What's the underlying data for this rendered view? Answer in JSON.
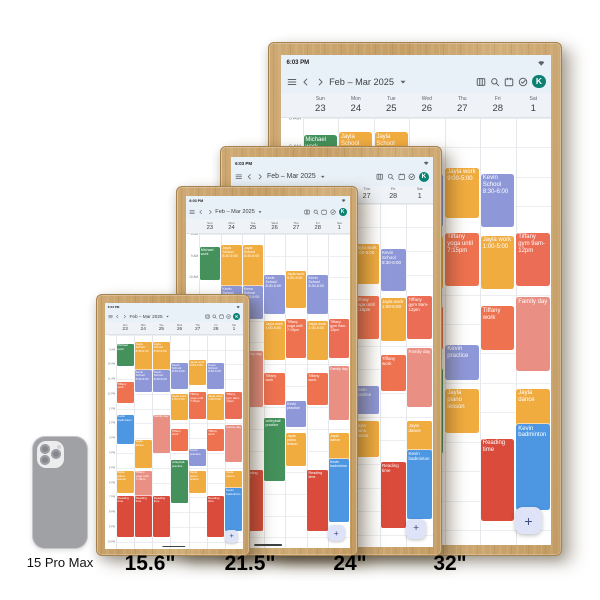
{
  "phone": {
    "label": "15 Pro Max"
  },
  "displays": [
    {
      "label": "15.6\""
    },
    {
      "label": "21.5\""
    },
    {
      "label": "24\""
    },
    {
      "label": "32\""
    }
  ],
  "calendar": {
    "status": {
      "time": "6:03 PM",
      "right_icon": "wifi-icon"
    },
    "title": "Feb – Mar 2025",
    "toolbar_icons": [
      "menu",
      "chevron-left",
      "chevron-right",
      "caret-down",
      "week-view",
      "search",
      "date",
      "tasks"
    ],
    "avatar": "K",
    "avatar_color": "#0b8073",
    "fab": "+",
    "days": [
      {
        "name": "Sun",
        "num": "23"
      },
      {
        "name": "Mon",
        "num": "24"
      },
      {
        "name": "Tue",
        "num": "25"
      },
      {
        "name": "Wed",
        "num": "26"
      },
      {
        "name": "Thu",
        "num": "27"
      },
      {
        "name": "Fri",
        "num": "28"
      },
      {
        "name": "Sat",
        "num": "1"
      }
    ],
    "time_labels": [
      "8 AM",
      "9 AM",
      "10 AM",
      "11 AM",
      "12 PM",
      "1 PM",
      "2 PM",
      "3 PM",
      "4 PM",
      "5 PM",
      "6 PM",
      "7 PM",
      "8 PM",
      "9 PM",
      "10 PM"
    ],
    "colors": {
      "yellow": "#F1AC40",
      "purple": "#8E98D8",
      "orange": "#EE7150",
      "salmon": "#E98F83",
      "gymred": "#EB6D56",
      "red": "#DA4B3B",
      "green": "#44915C",
      "blue": "#4D97E2"
    },
    "events": [
      {
        "day": 0,
        "label": "Michael work",
        "color": "green",
        "start": 8.6,
        "end": 10.1
      },
      {
        "day": 0,
        "label": "Tiffany work",
        "color": "orange",
        "start": 11.2,
        "end": 12.6
      },
      {
        "day": 0,
        "label": "Kevin badminton",
        "color": "blue",
        "start": 13.4,
        "end": 15.4
      },
      {
        "day": 0,
        "label": "Jayla piano lesson",
        "color": "yellow",
        "start": 17.2,
        "end": 18.7
      },
      {
        "day": 0,
        "label": "Reading time",
        "color": "red",
        "start": 18.9,
        "end": 21.7
      },
      {
        "day": 1,
        "label": "Jayla School 8:30-6:00",
        "color": "yellow",
        "start": 8.5,
        "end": 10.4
      },
      {
        "day": 1,
        "label": "Kevin School 8:30-6:00",
        "color": "purple",
        "start": 10.4,
        "end": 11.9
      },
      {
        "day": 1,
        "label": "Jayla dance",
        "color": "yellow",
        "start": 15.1,
        "end": 17.0
      },
      {
        "day": 1,
        "label": "Tiffany yoga until 7:15pm",
        "color": "salmon",
        "start": 17.2,
        "end": 18.9
      },
      {
        "day": 1,
        "label": "Reading time",
        "color": "red",
        "start": 18.9,
        "end": 21.7
      },
      {
        "day": 2,
        "label": "Jayla School 8:30-6:00",
        "color": "yellow",
        "start": 8.5,
        "end": 10.4
      },
      {
        "day": 2,
        "label": "Kevin School 8:30-6:00",
        "color": "purple",
        "start": 10.4,
        "end": 11.9
      },
      {
        "day": 2,
        "label": "Family day",
        "color": "salmon",
        "start": 13.4,
        "end": 16.0
      },
      {
        "day": 2,
        "label": "Reading time",
        "color": "red",
        "start": 18.9,
        "end": 21.7
      },
      {
        "day": 3,
        "label": "Kevin School 8:30-6:00",
        "color": "purple",
        "start": 9.9,
        "end": 11.7
      },
      {
        "day": 3,
        "label": "Jayla work 1:00-5:00",
        "color": "yellow",
        "start": 12.0,
        "end": 13.8
      },
      {
        "day": 3,
        "label": "Tiffany work",
        "color": "orange",
        "start": 14.4,
        "end": 15.9
      },
      {
        "day": 3,
        "label": "volleyball practice",
        "color": "green",
        "start": 16.5,
        "end": 19.4
      },
      {
        "day": 4,
        "label": "Jayla work 9:00-5:00",
        "color": "yellow",
        "start": 9.7,
        "end": 11.4
      },
      {
        "day": 4,
        "label": "Tiffany yoga until 7:15pm",
        "color": "orange",
        "start": 11.9,
        "end": 13.7
      },
      {
        "day": 4,
        "label": "Kevin practice",
        "color": "purple",
        "start": 15.7,
        "end": 16.9
      },
      {
        "day": 4,
        "label": "Jayla piano lesson",
        "color": "yellow",
        "start": 17.2,
        "end": 18.7
      },
      {
        "day": 5,
        "label": "Kevin School 8:30-6:00",
        "color": "purple",
        "start": 9.9,
        "end": 11.7
      },
      {
        "day": 5,
        "label": "Jayla work 1:00-5:00",
        "color": "yellow",
        "start": 12.0,
        "end": 13.8
      },
      {
        "day": 5,
        "label": "Tiffany work",
        "color": "orange",
        "start": 14.4,
        "end": 15.9
      },
      {
        "day": 5,
        "label": "Reading time",
        "color": "red",
        "start": 18.9,
        "end": 21.7
      },
      {
        "day": 6,
        "label": "Tiffany gym 9am-12pm",
        "color": "gymred",
        "start": 11.9,
        "end": 13.7
      },
      {
        "day": 6,
        "label": "Family day",
        "color": "salmon",
        "start": 14.1,
        "end": 16.6
      },
      {
        "day": 6,
        "label": "Jayla dance",
        "color": "yellow",
        "start": 17.2,
        "end": 18.7
      },
      {
        "day": 6,
        "label": "Kevin badminton",
        "color": "blue",
        "start": 18.4,
        "end": 21.3
      }
    ]
  }
}
